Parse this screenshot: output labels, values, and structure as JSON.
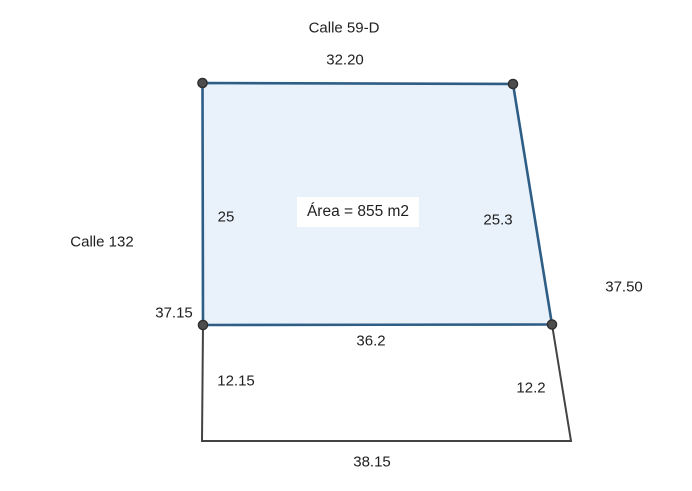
{
  "diagram": {
    "streets": {
      "top": "Calle 59-D",
      "left": "Calle 132"
    },
    "parcel": {
      "area_label": "Área = 855 m2",
      "side_lengths": {
        "top": "32.20",
        "left": "25",
        "right": "25.3",
        "bottom": "36.2"
      },
      "fill": "#e9f1fa",
      "stroke": "#2e5e86",
      "vertex_fill": "#4d4d4d"
    },
    "adjacent_lot": {
      "side_lengths": {
        "left": "12.15",
        "right": "12.2",
        "bottom": "38.15"
      },
      "stroke": "#434343"
    },
    "overall_lengths": {
      "left": "37.15",
      "right": "37.50"
    }
  }
}
